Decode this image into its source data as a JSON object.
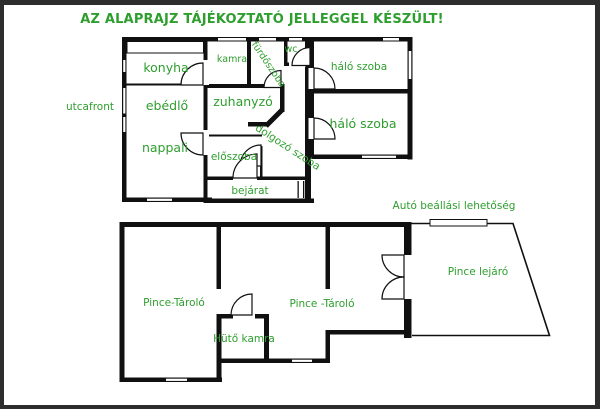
{
  "title": "AZ ALAPRAJZ TÁJÉKOZTATÓ JELLEGGEL KÉSZÜLT!",
  "street_front_label": "utcafront",
  "colors": {
    "label_green": "#2E9E2E",
    "wall_black": "#101010",
    "frame_border": "#2D2D2D",
    "background": "#FFFFFF"
  },
  "upper_floor": {
    "rooms": {
      "konyha": "konyha",
      "ebedlo": "ebédlő",
      "nappali": "nappali",
      "kamra": "kamra",
      "furdoszoba": "fürdőszoba",
      "wc": "wc",
      "zuhanyzo": "zuhanyzó",
      "eloszoba": "előszoba",
      "dolgozo_szoba": "dolgozó szoba",
      "bejarat": "bejárat",
      "halo_szoba_felso": "háló szoba",
      "halo_szoba_also": "háló szoba"
    }
  },
  "lower_floor": {
    "rooms": {
      "pince_tarolo_bal": "Pince-Tároló",
      "pince_tarolo_jobb": "Pince -Tároló",
      "huto_kamra": "Hütő kamra",
      "pince_lejaro": "Pince lejáró"
    },
    "annotations": {
      "auto_beallas": "Autó beállási lehetőség"
    }
  }
}
